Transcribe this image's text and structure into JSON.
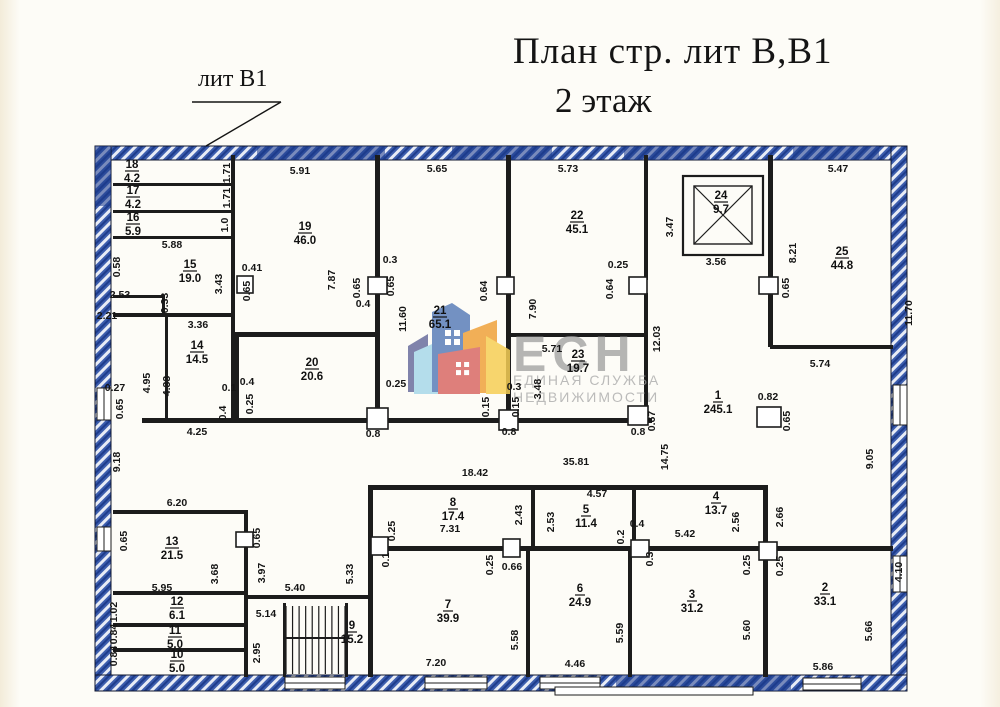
{
  "title": {
    "line1": "План стр. лит В,В1",
    "line2": "2 этаж"
  },
  "callout": {
    "label": "лит В1"
  },
  "watermark": {
    "abbr": "ЕСН",
    "line1": "ЕДИНАЯ СЛУЖБА",
    "line2": "НЕДВИЖИМОСТИ"
  },
  "colors": {
    "wall_black": "#1c1c1c",
    "outer_wall_blue": "#3c5dad",
    "outer_wall_navy": "#1e3c8c",
    "paper": "#fdfcf7",
    "watermark_gray": "#9a9a9a",
    "logo_purple": "#6b6f9e",
    "logo_lightblue": "#a8d8ea",
    "logo_blue": "#5b7fb9",
    "logo_orange": "#f0a23c",
    "logo_yellow": "#f6cf55",
    "logo_red": "#d96a66"
  },
  "plan": {
    "outer_blue": [
      [
        95,
        146,
        812,
        14
      ],
      [
        95,
        146,
        16,
        545
      ],
      [
        891,
        146,
        16,
        545
      ],
      [
        95,
        675,
        812,
        16
      ]
    ],
    "navy_segments": [
      [
        257,
        146,
        128,
        14
      ],
      [
        452,
        146,
        100,
        14
      ],
      [
        624,
        146,
        86,
        14
      ],
      [
        793,
        146,
        86,
        14
      ],
      [
        616,
        675,
        175,
        16
      ],
      [
        95,
        146,
        16,
        60
      ]
    ],
    "windows": [
      [
        97,
        388,
        14,
        32
      ],
      [
        97,
        527,
        14,
        24
      ],
      [
        285,
        677,
        60,
        12
      ],
      [
        425,
        677,
        62,
        12
      ],
      [
        540,
        677,
        60,
        12
      ],
      [
        803,
        678,
        58,
        12
      ],
      [
        893,
        385,
        14,
        40
      ],
      [
        893,
        556,
        14,
        36
      ]
    ],
    "walls": [
      [
        113,
        183,
        120,
        3
      ],
      [
        113,
        210,
        120,
        3
      ],
      [
        113,
        236,
        120,
        3
      ],
      [
        231,
        155,
        4,
        180
      ],
      [
        113,
        313,
        122,
        4
      ],
      [
        113,
        295,
        52,
        3
      ],
      [
        162,
        297,
        3,
        20
      ],
      [
        165,
        315,
        3,
        105
      ],
      [
        231,
        315,
        4,
        105
      ],
      [
        235,
        332,
        145,
        5
      ],
      [
        235,
        337,
        4,
        83
      ],
      [
        375,
        155,
        5,
        125
      ],
      [
        375,
        293,
        5,
        120
      ],
      [
        142,
        418,
        510,
        5
      ],
      [
        506,
        155,
        5,
        125
      ],
      [
        506,
        293,
        5,
        125
      ],
      [
        506,
        333,
        142,
        4
      ],
      [
        644,
        155,
        4,
        125
      ],
      [
        644,
        293,
        4,
        127
      ],
      [
        768,
        155,
        5,
        125
      ],
      [
        768,
        293,
        5,
        54
      ],
      [
        770,
        345,
        123,
        4
      ],
      [
        113,
        510,
        135,
        4
      ],
      [
        244,
        510,
        4,
        167
      ],
      [
        113,
        591,
        133,
        4
      ],
      [
        113,
        623,
        133,
        4
      ],
      [
        113,
        648,
        133,
        4
      ],
      [
        248,
        595,
        122,
        4
      ],
      [
        283,
        603,
        3,
        74
      ],
      [
        345,
        603,
        3,
        74
      ],
      [
        368,
        485,
        5,
        192
      ],
      [
        368,
        485,
        400,
        5
      ],
      [
        531,
        488,
        4,
        60
      ],
      [
        632,
        488,
        4,
        60
      ],
      [
        368,
        546,
        525,
        5
      ],
      [
        526,
        551,
        4,
        126
      ],
      [
        628,
        551,
        4,
        126
      ],
      [
        763,
        485,
        5,
        192
      ]
    ],
    "columns": [
      [
        237,
        276,
        16,
        17
      ],
      [
        368,
        277,
        19,
        17
      ],
      [
        497,
        277,
        17,
        17
      ],
      [
        629,
        277,
        18,
        17
      ],
      [
        759,
        277,
        19,
        17
      ],
      [
        367,
        408,
        21,
        21
      ],
      [
        499,
        410,
        19,
        20
      ],
      [
        628,
        406,
        20,
        19
      ],
      [
        757,
        407,
        24,
        20
      ],
      [
        236,
        532,
        17,
        15
      ],
      [
        371,
        537,
        17,
        18
      ],
      [
        503,
        539,
        17,
        18
      ],
      [
        631,
        540,
        18,
        17
      ],
      [
        759,
        542,
        18,
        18
      ]
    ],
    "shaft": {
      "outer": [
        683,
        176,
        80,
        79
      ],
      "inner": [
        694,
        186,
        58,
        58
      ]
    },
    "stairs": {
      "x": 286,
      "y": 606,
      "w": 59,
      "h": 68,
      "steps": 9
    },
    "leader": [
      [
        192,
        102,
        281,
        102
      ],
      [
        281,
        102,
        206,
        146
      ]
    ],
    "porch": [
      555,
      687,
      198,
      8
    ],
    "rooms": [
      [
        "18",
        "4.2",
        132,
        168
      ],
      [
        "17",
        "4.2",
        133,
        194
      ],
      [
        "16",
        "5.9",
        133,
        221
      ],
      [
        "15",
        "19.0",
        190,
        268
      ],
      [
        "14",
        "14.5",
        197,
        349
      ],
      [
        "19",
        "46.0",
        305,
        230
      ],
      [
        "20",
        "20.6",
        312,
        366
      ],
      [
        "21",
        "65.1",
        440,
        314
      ],
      [
        "22",
        "45.1",
        577,
        219
      ],
      [
        "23",
        "19.7",
        578,
        358
      ],
      [
        "24",
        "9.7",
        721,
        199
      ],
      [
        "25",
        "44.8",
        842,
        255
      ],
      [
        "1",
        "245.1",
        718,
        399
      ],
      [
        "13",
        "21.5",
        172,
        545
      ],
      [
        "12",
        "6.1",
        177,
        605
      ],
      [
        "11",
        "5.0",
        175,
        634
      ],
      [
        "10",
        "5.0",
        177,
        658
      ],
      [
        "9",
        "15.2",
        352,
        629
      ],
      [
        "8",
        "17.4",
        453,
        506
      ],
      [
        "5",
        "11.4",
        586,
        513
      ],
      [
        "4",
        "13.7",
        716,
        500
      ],
      [
        "7",
        "39.9",
        448,
        608
      ],
      [
        "6",
        "24.9",
        580,
        592
      ],
      [
        "3",
        "31.2",
        692,
        598
      ],
      [
        "2",
        "33.1",
        825,
        591
      ]
    ],
    "dims": [
      [
        "5.91",
        300,
        174,
        0
      ],
      [
        "5.65",
        437,
        172,
        0
      ],
      [
        "5.73",
        568,
        172,
        0
      ],
      [
        "5.47",
        838,
        172,
        0
      ],
      [
        "5.88",
        172,
        248,
        0
      ],
      [
        "0.41",
        252,
        271,
        0
      ],
      [
        "0.3",
        390,
        263,
        0
      ],
      [
        "0.25",
        618,
        268,
        0
      ],
      [
        "3.56",
        716,
        265,
        0
      ],
      [
        "3.36",
        198,
        328,
        0
      ],
      [
        "2.53",
        120,
        298,
        0
      ],
      [
        "2.21",
        107,
        319,
        0
      ],
      [
        "0.4",
        363,
        307,
        0
      ],
      [
        "0.27",
        115,
        391,
        0
      ],
      [
        "0.1",
        229,
        391,
        0
      ],
      [
        "0.4",
        247,
        385,
        0
      ],
      [
        "5.71",
        552,
        352,
        0
      ],
      [
        "5.74",
        820,
        367,
        0
      ],
      [
        "0.82",
        768,
        400,
        0
      ],
      [
        "0.25",
        396,
        387,
        0
      ],
      [
        "0.3",
        514,
        390,
        0
      ],
      [
        "4.25",
        197,
        435,
        0
      ],
      [
        "0.8",
        373,
        437,
        0
      ],
      [
        "0.8",
        509,
        435,
        0
      ],
      [
        "0.8",
        638,
        435,
        0
      ],
      [
        "35.81",
        576,
        465,
        0
      ],
      [
        "18.42",
        475,
        476,
        0
      ],
      [
        "4.57",
        597,
        497,
        0
      ],
      [
        "7.31",
        450,
        532,
        0
      ],
      [
        "0.66",
        512,
        570,
        0
      ],
      [
        "0.4",
        637,
        527,
        0
      ],
      [
        "5.42",
        685,
        537,
        0
      ],
      [
        "6.20",
        177,
        506,
        0
      ],
      [
        "5.95",
        162,
        591,
        0
      ],
      [
        "5.40",
        295,
        591,
        0
      ],
      [
        "5.14",
        266,
        617,
        0
      ],
      [
        "7.20",
        436,
        666,
        0
      ],
      [
        "4.46",
        575,
        667,
        0
      ],
      [
        "5.86",
        823,
        670,
        0
      ],
      [
        "1.71",
        230,
        173,
        1
      ],
      [
        "1.71",
        230,
        198,
        1
      ],
      [
        "1.0",
        228,
        225,
        1
      ],
      [
        "0.58",
        120,
        267,
        1
      ],
      [
        "3.43",
        222,
        284,
        1
      ],
      [
        "0.65",
        250,
        291,
        1
      ],
      [
        "7.87",
        335,
        280,
        1
      ],
      [
        "0.65",
        360,
        288,
        1
      ],
      [
        "0.65",
        394,
        286,
        1
      ],
      [
        "11.60",
        406,
        319,
        1
      ],
      [
        "0.64",
        487,
        291,
        1
      ],
      [
        "7.90",
        536,
        309,
        1
      ],
      [
        "0.64",
        613,
        289,
        1
      ],
      [
        "3.47",
        673,
        227,
        1
      ],
      [
        "0.65",
        789,
        288,
        1
      ],
      [
        "8.21",
        796,
        253,
        1
      ],
      [
        "12.03",
        660,
        339,
        1
      ],
      [
        "3.48",
        541,
        389,
        1
      ],
      [
        "0.15",
        489,
        407,
        1
      ],
      [
        "0.15",
        519,
        407,
        1
      ],
      [
        "0.25",
        253,
        404,
        1
      ],
      [
        "0.4",
        226,
        413,
        1
      ],
      [
        "0.33",
        168,
        303,
        1
      ],
      [
        "4.95",
        150,
        383,
        1
      ],
      [
        "4.33",
        170,
        386,
        1
      ],
      [
        "9.18",
        120,
        462,
        1
      ],
      [
        "0.65",
        123,
        409,
        1
      ],
      [
        "0.67",
        655,
        421,
        1
      ],
      [
        "0.65",
        790,
        421,
        1
      ],
      [
        "14.75",
        668,
        457,
        1
      ],
      [
        "9.05",
        873,
        459,
        1
      ],
      [
        "11.70",
        912,
        313,
        1
      ],
      [
        "0.25",
        395,
        531,
        1
      ],
      [
        "0.1",
        389,
        560,
        1
      ],
      [
        "2.43",
        522,
        515,
        1
      ],
      [
        "2.53",
        554,
        522,
        1
      ],
      [
        "0.2",
        624,
        537,
        1
      ],
      [
        "0.25",
        493,
        565,
        1
      ],
      [
        "2.56",
        739,
        522,
        1
      ],
      [
        "2.66",
        783,
        517,
        1
      ],
      [
        "0.3",
        653,
        559,
        1
      ],
      [
        "0.25",
        750,
        565,
        1
      ],
      [
        "0.25",
        783,
        566,
        1
      ],
      [
        "0.65",
        127,
        541,
        1
      ],
      [
        "0.65",
        260,
        538,
        1
      ],
      [
        "3.68",
        218,
        574,
        1
      ],
      [
        "3.97",
        265,
        573,
        1
      ],
      [
        "5.33",
        353,
        574,
        1
      ],
      [
        "1.02",
        117,
        612,
        1
      ],
      [
        "0.84",
        117,
        634,
        1
      ],
      [
        "0.84",
        117,
        656,
        1
      ],
      [
        "2.95",
        260,
        653,
        1
      ],
      [
        "5.58",
        518,
        640,
        1
      ],
      [
        "5.59",
        623,
        633,
        1
      ],
      [
        "5.60",
        750,
        630,
        1
      ],
      [
        "5.66",
        872,
        631,
        1
      ],
      [
        "4.10",
        902,
        572,
        1
      ]
    ],
    "logo": {
      "cx": 455,
      "polys": [
        [
          "logo_purple",
          "408,392 408,346 428,334 428,392"
        ],
        [
          "logo_lightblue",
          "414,394 414,352 448,337 448,394"
        ],
        [
          "logo_blue",
          "432,392 432,312 452,303 470,315 470,392"
        ],
        [
          "logo_orange",
          "463,393 463,333 497,320 497,393"
        ],
        [
          "logo_yellow",
          "486,394 486,336 510,350 510,394"
        ],
        [
          "logo_red",
          "438,394 438,354 480,347 480,394"
        ]
      ],
      "windows_blue": [
        445,
        330
      ],
      "windows_red": [
        456,
        362
      ]
    },
    "watermark_pos": {
      "abbr": [
        513,
        371
      ],
      "line1": [
        513,
        385
      ],
      "line2": [
        513,
        402
      ]
    }
  }
}
